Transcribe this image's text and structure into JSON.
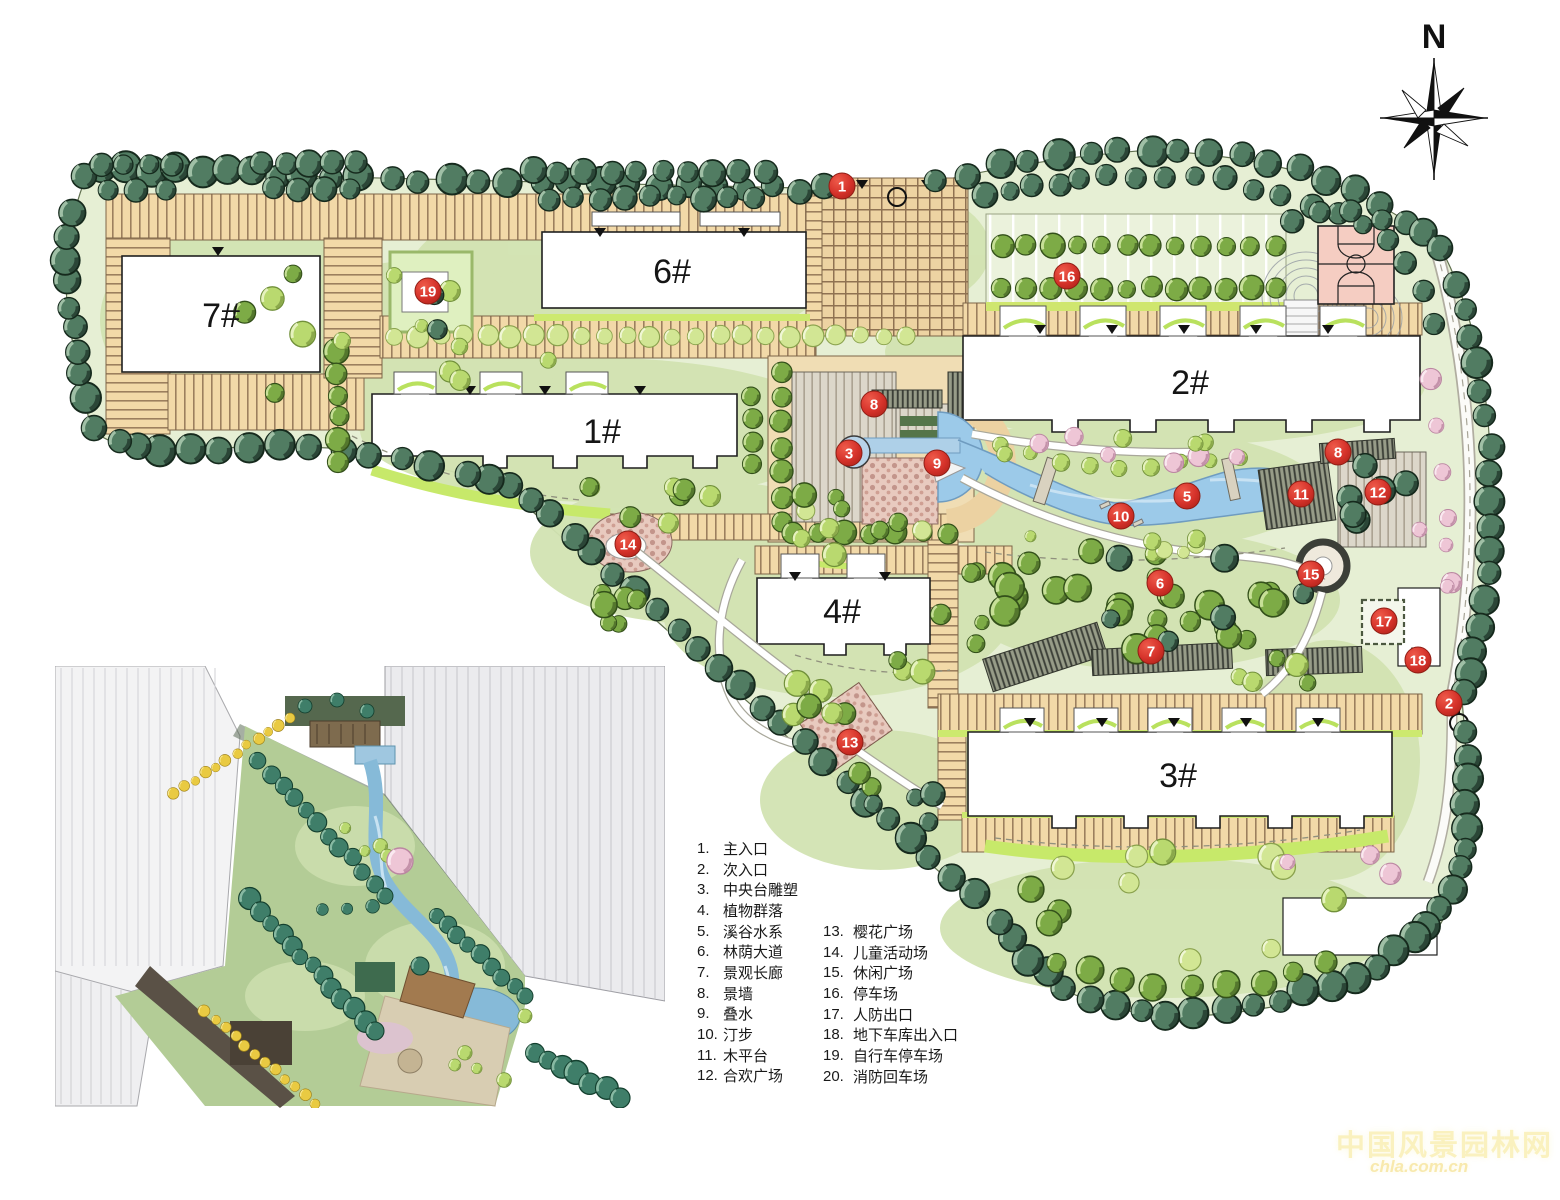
{
  "north_arrow": {
    "label": "N"
  },
  "plan": {
    "buildings": [
      {
        "id": "7",
        "label": "7#"
      },
      {
        "id": "6",
        "label": "6#"
      },
      {
        "id": "1",
        "label": "1#"
      },
      {
        "id": "2",
        "label": "2#"
      },
      {
        "id": "4",
        "label": "4#"
      },
      {
        "id": "3",
        "label": "3#"
      }
    ],
    "markers": [
      {
        "num": "1",
        "x": 842,
        "y": 186
      },
      {
        "num": "2",
        "x": 1449,
        "y": 703
      },
      {
        "num": "3",
        "x": 849,
        "y": 453
      },
      {
        "num": "5",
        "x": 1187,
        "y": 496
      },
      {
        "num": "6",
        "x": 1160,
        "y": 583
      },
      {
        "num": "7",
        "x": 1151,
        "y": 651
      },
      {
        "num": "8",
        "x": 874,
        "y": 404
      },
      {
        "num": "8",
        "x": 1338,
        "y": 452
      },
      {
        "num": "9",
        "x": 937,
        "y": 463
      },
      {
        "num": "10",
        "x": 1121,
        "y": 516
      },
      {
        "num": "11",
        "x": 1301,
        "y": 494
      },
      {
        "num": "12",
        "x": 1378,
        "y": 492
      },
      {
        "num": "13",
        "x": 850,
        "y": 742
      },
      {
        "num": "14",
        "x": 628,
        "y": 544
      },
      {
        "num": "15",
        "x": 1311,
        "y": 574
      },
      {
        "num": "16",
        "x": 1067,
        "y": 276
      },
      {
        "num": "17",
        "x": 1384,
        "y": 621
      },
      {
        "num": "18",
        "x": 1418,
        "y": 660
      },
      {
        "num": "19",
        "x": 428,
        "y": 291
      }
    ]
  },
  "legend": {
    "items": [
      {
        "num": "1.",
        "label": "主入口"
      },
      {
        "num": "2.",
        "label": "次入口"
      },
      {
        "num": "3.",
        "label": "中央台雕塑"
      },
      {
        "num": "4.",
        "label": "植物群落"
      },
      {
        "num": "5.",
        "label": "溪谷水系"
      },
      {
        "num": "6.",
        "label": "林荫大道"
      },
      {
        "num": "7.",
        "label": "景观长廊"
      },
      {
        "num": "8.",
        "label": "景墙"
      },
      {
        "num": "9.",
        "label": "叠水"
      },
      {
        "num": "10.",
        "label": "汀步"
      },
      {
        "num": "11.",
        "label": "木平台"
      },
      {
        "num": "12.",
        "label": "合欢广场"
      },
      {
        "num": "13.",
        "label": "樱花广场"
      },
      {
        "num": "14.",
        "label": "儿童活动场"
      },
      {
        "num": "15.",
        "label": "休闲广场"
      },
      {
        "num": "16.",
        "label": "停车场"
      },
      {
        "num": "17.",
        "label": "人防出口"
      },
      {
        "num": "18.",
        "label": "地下车库出入口"
      },
      {
        "num": "19.",
        "label": "自行车停车场"
      },
      {
        "num": "20.",
        "label": "消防回车场"
      }
    ]
  },
  "watermark": {
    "title": "中国风景园林网",
    "subtitle": "chla.com.cn"
  },
  "colors": {
    "site_green": "#e6efd4",
    "lawn": "#d2e3b2",
    "path_tan": "#f2d9a8",
    "water": "#9ccae9",
    "marker_red": "#d5322a",
    "lime": "#c7e96a",
    "court_pink": "#f5cdc2",
    "dark_tree": "#517c62"
  }
}
